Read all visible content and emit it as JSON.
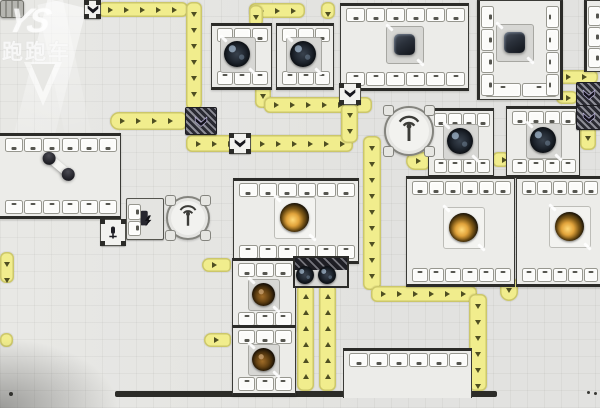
{
  "window": {
    "width": 600,
    "height": 408
  },
  "watermark": {
    "logo_text": "YS",
    "site_text": "跑跑车",
    "badge_icon": "triangle-badge-icon"
  },
  "colors": {
    "background": "#e7e7e4",
    "belt": "#f1ed8d",
    "belt_edge": "#968f37",
    "arrow": "#4f4f22",
    "building_border": "#2b2b28",
    "building_body": "#ecece9",
    "slot": "#fbfbf9",
    "machine_dark": "#1a2028",
    "machine_gold": "#e2a43c",
    "machine_amber": "#a06c28",
    "wall": "#2c2c28"
  },
  "belts": [
    {
      "x": 98,
      "y": 2,
      "w": 90,
      "h": 15,
      "dir": "right"
    },
    {
      "x": 186,
      "y": 2,
      "w": 16,
      "h": 108,
      "dir": "down"
    },
    {
      "x": 110,
      "y": 112,
      "w": 77,
      "h": 18,
      "dir": "right",
      "cap": "left"
    },
    {
      "x": 186,
      "y": 135,
      "w": 167,
      "h": 17,
      "dir": "right"
    },
    {
      "x": 255,
      "y": 84,
      "w": 16,
      "h": 24,
      "dir": "down"
    },
    {
      "x": 264,
      "y": 97,
      "w": 108,
      "h": 16,
      "dir": "right"
    },
    {
      "x": 341,
      "y": 103,
      "w": 17,
      "h": 40,
      "dir": "down"
    },
    {
      "x": 363,
      "y": 136,
      "w": 18,
      "h": 154,
      "dir": "down"
    },
    {
      "x": 371,
      "y": 286,
      "w": 106,
      "h": 16,
      "dir": "right"
    },
    {
      "x": 469,
      "y": 294,
      "w": 18,
      "h": 97,
      "dir": "down"
    },
    {
      "x": 249,
      "y": 3,
      "w": 56,
      "h": 15,
      "dir": "right"
    },
    {
      "x": 249,
      "y": 5,
      "w": 14,
      "h": 22,
      "dir": "down"
    },
    {
      "x": 321,
      "y": 2,
      "w": 14,
      "h": 17,
      "dir": "down"
    },
    {
      "x": 0,
      "y": 252,
      "w": 14,
      "h": 31,
      "dir": "down"
    },
    {
      "x": 0,
      "y": 333,
      "w": 13,
      "h": 14,
      "dir": "right"
    },
    {
      "x": 204,
      "y": 333,
      "w": 27,
      "h": 14,
      "dir": "right",
      "cap": "left"
    },
    {
      "x": 202,
      "y": 258,
      "w": 29,
      "h": 14,
      "dir": "right",
      "cap": "left"
    },
    {
      "x": 297,
      "y": 284,
      "w": 17,
      "h": 107,
      "dir": "up"
    },
    {
      "x": 319,
      "y": 284,
      "w": 17,
      "h": 107,
      "dir": "up"
    },
    {
      "x": 500,
      "y": 278,
      "w": 18,
      "h": 23,
      "dir": "down",
      "cap": "bottom"
    },
    {
      "x": 556,
      "y": 70,
      "w": 42,
      "h": 14,
      "dir": "right"
    },
    {
      "x": 556,
      "y": 91,
      "w": 22,
      "h": 13,
      "dir": "right"
    },
    {
      "x": 580,
      "y": 126,
      "w": 16,
      "h": 24,
      "dir": "down"
    },
    {
      "x": 406,
      "y": 152,
      "w": 24,
      "h": 18,
      "dir": "right",
      "cap": "left"
    },
    {
      "x": 492,
      "y": 152,
      "w": 18,
      "h": 15,
      "dir": "right"
    }
  ],
  "buildings": [
    {
      "name": "assembler-a",
      "x": 211,
      "y": 23,
      "w": 59,
      "h": 61,
      "st": 3,
      "sb": 3,
      "machine": {
        "type": "fan",
        "cx": 237,
        "cy": 54
      }
    },
    {
      "name": "assembler-b",
      "x": 276,
      "y": 23,
      "w": 56,
      "h": 61,
      "st": 3,
      "sb": 3,
      "machine": {
        "type": "fan",
        "cx": 303,
        "cy": 54
      }
    },
    {
      "name": "assembler-c",
      "x": 340,
      "y": 3,
      "w": 127,
      "h": 82,
      "st": 6,
      "sb": 6,
      "machine": {
        "type": "cube",
        "cx": 404,
        "cy": 44
      }
    },
    {
      "name": "assembler-d",
      "x": 477,
      "y": 0,
      "w": 80,
      "h": 98,
      "vert": true,
      "sl": 4,
      "sr": 4,
      "sb": 2,
      "machine": {
        "type": "cube",
        "cx": 514,
        "cy": 42
      }
    },
    {
      "name": "assembler-e",
      "x": 584,
      "y": 0,
      "w": 16,
      "h": 70,
      "vert": true,
      "sl": 3,
      "cut": "right"
    },
    {
      "name": "assembler-f",
      "x": 506,
      "y": 106,
      "w": 72,
      "h": 66,
      "st": 4,
      "sb": 4,
      "machine": {
        "type": "fan",
        "cx": 543,
        "cy": 140
      }
    },
    {
      "name": "assembler-g",
      "x": 428,
      "y": 108,
      "w": 64,
      "h": 64,
      "st": 4,
      "sb": 4,
      "machine": {
        "type": "fan",
        "cx": 460,
        "cy": 141
      }
    },
    {
      "name": "refinery-h",
      "x": 406,
      "y": 176,
      "w": 107,
      "h": 105,
      "st": 6,
      "sb": 6,
      "machine": {
        "type": "gold",
        "cx": 463,
        "cy": 227
      }
    },
    {
      "name": "refinery-i",
      "x": 516,
      "y": 176,
      "w": 84,
      "h": 105,
      "st": 5,
      "sb": 5,
      "machine": {
        "type": "gold",
        "cx": 569,
        "cy": 226
      }
    },
    {
      "name": "refinery-j",
      "x": 233,
      "y": 178,
      "w": 124,
      "h": 80,
      "st": 6,
      "sb": 6,
      "machine": {
        "type": "gold",
        "cx": 294,
        "cy": 217
      }
    },
    {
      "name": "extractor-l",
      "x": 232,
      "y": 258,
      "w": 62,
      "h": 67,
      "st": 3,
      "sb": 3,
      "machine": {
        "type": "amber",
        "cx": 263,
        "cy": 294
      }
    },
    {
      "name": "extractor-m",
      "x": 232,
      "y": 325,
      "w": 62,
      "h": 65,
      "st": 3,
      "sb": 3,
      "machine": {
        "type": "amber",
        "cx": 263,
        "cy": 359
      }
    },
    {
      "name": "depot-n",
      "x": 343,
      "y": 348,
      "w": 127,
      "h": 47,
      "st": 6,
      "cut": "bottom"
    },
    {
      "name": "warehouse-o",
      "x": 0,
      "y": 133,
      "w": 120,
      "h": 80,
      "st": 6,
      "sb": 6,
      "cut": "left"
    }
  ],
  "devices": [
    {
      "type": "chevron",
      "name": "filter-device",
      "x": 84,
      "y": 0,
      "w": 15,
      "h": 17
    },
    {
      "type": "chevron",
      "name": "filter-device",
      "x": 229,
      "y": 133,
      "w": 20,
      "h": 19
    },
    {
      "type": "chevron",
      "name": "filter-device",
      "x": 339,
      "y": 83,
      "w": 20,
      "h": 20
    },
    {
      "type": "striped",
      "name": "merger-device",
      "x": 185,
      "y": 107,
      "w": 30,
      "h": 26
    },
    {
      "type": "striped",
      "name": "merger-device",
      "x": 576,
      "y": 82,
      "w": 23,
      "h": 23
    },
    {
      "type": "striped",
      "name": "merger-device",
      "x": 576,
      "y": 105,
      "w": 23,
      "h": 23
    },
    {
      "type": "loader",
      "name": "loader-device",
      "x": 100,
      "y": 219,
      "w": 24,
      "h": 25
    },
    {
      "type": "power",
      "name": "power-building",
      "x": 126,
      "y": 198,
      "w": 36,
      "h": 40
    }
  ],
  "antennas": [
    {
      "name": "beacon-building",
      "x": 166,
      "y": 196,
      "d": 40
    },
    {
      "name": "beacon-building",
      "x": 384,
      "y": 106,
      "d": 46
    }
  ],
  "weaver": {
    "name": "dual-extractor",
    "x": 293,
    "y": 256,
    "w": 52,
    "h": 28
  },
  "wall": {
    "x": 115,
    "y": 391,
    "w": 382,
    "h": 6
  },
  "items": [
    {
      "type": "dumbbell",
      "name": "item-dumbbell",
      "x": 42,
      "y": 160
    },
    {
      "type": "cart",
      "name": "item-cart",
      "x": 396,
      "y": 369,
      "w": 22,
      "h": 16
    }
  ],
  "dots": [
    {
      "x": 9,
      "y": 392,
      "s": 4
    },
    {
      "x": 587,
      "y": 391,
      "s": 3
    },
    {
      "x": 594,
      "y": 392,
      "s": 3
    }
  ]
}
